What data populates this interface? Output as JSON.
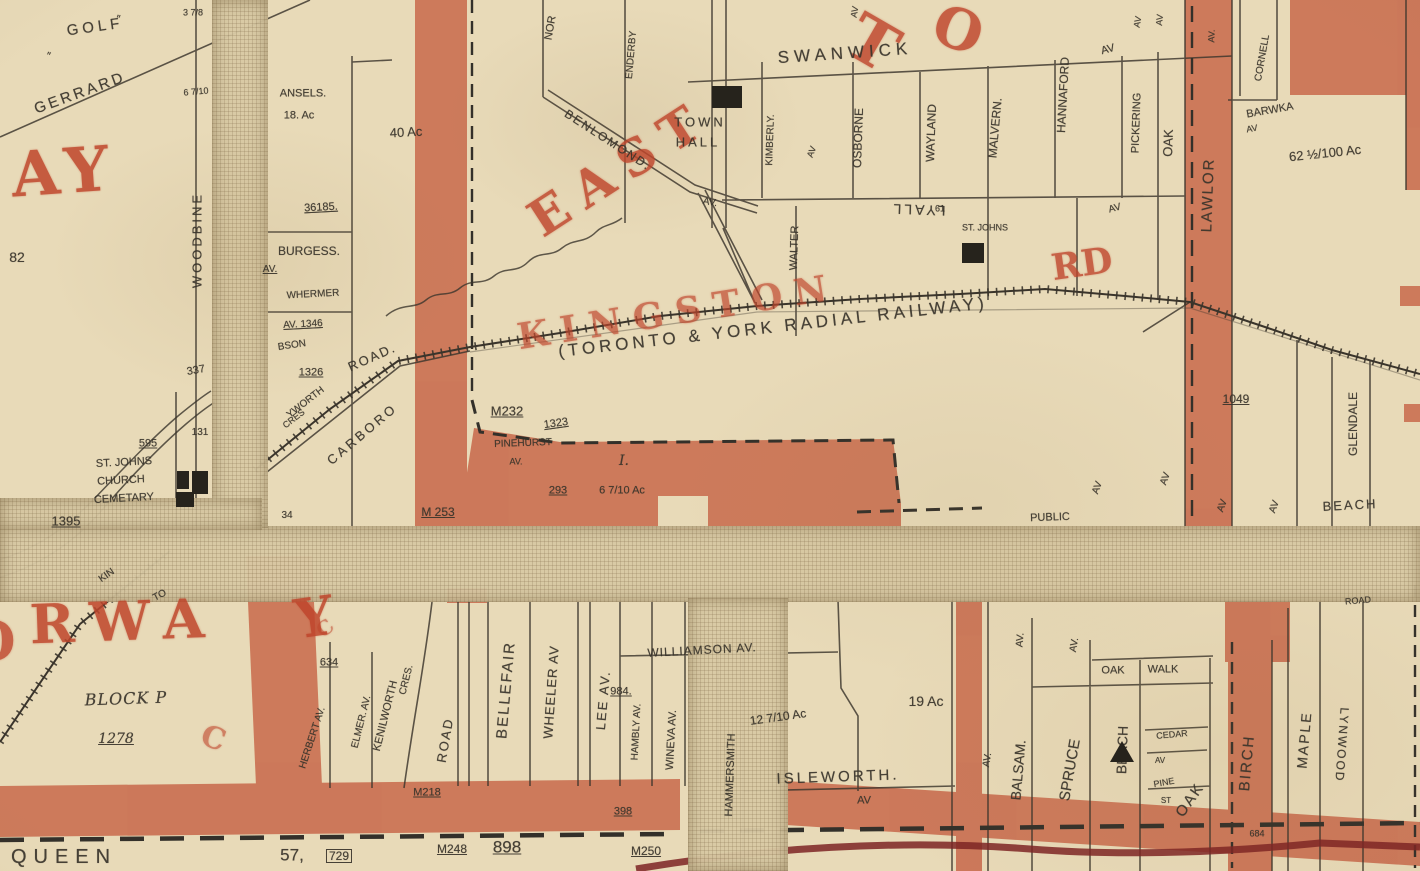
{
  "map": {
    "description": "Scanned historical plan map of East Toronto around Kingston Rd and the Toronto & York Radial Railway",
    "colors": {
      "paper": "#e8dab8",
      "road_fill": "#c8684a",
      "ink": "#39342b",
      "red": "#bf452b",
      "dark_red": "#7c2323"
    },
    "labels": [
      {
        "t": "GOLF",
        "x": 95,
        "y": 27,
        "r": -8,
        "s": 15,
        "ls": 4
      },
      {
        "t": "GERRARD",
        "x": 80,
        "y": 93,
        "r": -20,
        "s": 15,
        "ls": 3
      },
      {
        "t": "″",
        "x": 48,
        "y": 57,
        "r": 15,
        "s": 11
      },
      {
        "t": "″",
        "x": 118,
        "y": 20,
        "r": 10,
        "s": 11
      },
      {
        "t": "3 7/8",
        "x": 193,
        "y": 13,
        "r": 0,
        "s": 9
      },
      {
        "t": "6 7/10",
        "x": 196,
        "y": 92,
        "r": -5,
        "s": 9
      },
      {
        "t": "WOODBINE",
        "x": 197,
        "y": 240,
        "r": -90,
        "s": 13,
        "ls": 3
      },
      {
        "t": "82",
        "x": 17,
        "y": 257,
        "r": 0,
        "s": 14
      },
      {
        "t": "AY",
        "x": 64,
        "y": 172,
        "r": -4,
        "s": 62,
        "ls": 8,
        "cls": "red",
        "c": "red",
        "o": 0.85
      },
      {
        "t": "ANSELS.",
        "x": 303,
        "y": 94,
        "r": 0,
        "s": 11
      },
      {
        "t": "18. Ac",
        "x": 299,
        "y": 116,
        "r": 0,
        "s": 11
      },
      {
        "t": "40 Ac",
        "x": 406,
        "y": 132,
        "r": -3,
        "s": 13
      },
      {
        "t": "36185.",
        "x": 321,
        "y": 208,
        "r": -3,
        "s": 11,
        "cls": "u"
      },
      {
        "t": "BURGESS.",
        "x": 309,
        "y": 251,
        "r": 0,
        "s": 12
      },
      {
        "t": "AV.",
        "x": 270,
        "y": 270,
        "r": 0,
        "s": 10,
        "cls": "u"
      },
      {
        "t": "WHERMER",
        "x": 313,
        "y": 295,
        "r": -3,
        "s": 10
      },
      {
        "t": "AV. 1346",
        "x": 303,
        "y": 325,
        "r": -3,
        "s": 10,
        "cls": "u"
      },
      {
        "t": "BSON",
        "x": 292,
        "y": 346,
        "r": -8,
        "s": 10
      },
      {
        "t": "1326",
        "x": 311,
        "y": 373,
        "r": 0,
        "s": 11,
        "cls": "u"
      },
      {
        "t": "337",
        "x": 196,
        "y": 371,
        "r": -10,
        "s": 11
      },
      {
        "t": "131",
        "x": 200,
        "y": 433,
        "r": 0,
        "s": 10
      },
      {
        "t": "YWORTH",
        "x": 306,
        "y": 403,
        "r": -38,
        "s": 10
      },
      {
        "t": "CRES",
        "x": 294,
        "y": 419,
        "r": -38,
        "s": 9
      },
      {
        "t": "CARBORO",
        "x": 362,
        "y": 434,
        "r": -40,
        "s": 13,
        "ls": 3
      },
      {
        "t": "ROAD.",
        "x": 372,
        "y": 357,
        "r": -24,
        "s": 13,
        "ls": 2
      },
      {
        "t": "EAST",
        "x": 620,
        "y": 168,
        "r": -33,
        "s": 50,
        "ls": 14,
        "cls": "red",
        "c": "red",
        "o": 0.82
      },
      {
        "t": "KINGSTON",
        "x": 678,
        "y": 312,
        "r": -9,
        "s": 36,
        "ls": 12,
        "cls": "red",
        "c": "red",
        "o": 0.68
      },
      {
        "t": "RD",
        "x": 1082,
        "y": 264,
        "r": -8,
        "s": 36,
        "cls": "red",
        "c": "red",
        "o": 0.8
      },
      {
        "t": "T",
        "x": 872,
        "y": 44,
        "r": 30,
        "s": 64,
        "cls": "red",
        "c": "red",
        "o": 0.82
      },
      {
        "t": "O",
        "x": 958,
        "y": 30,
        "r": 20,
        "s": 56,
        "cls": "red",
        "c": "red",
        "o": 0.82
      },
      {
        "t": "NOR",
        "x": 551,
        "y": 28,
        "r": -80,
        "s": 11
      },
      {
        "t": "ENDERBY",
        "x": 632,
        "y": 55,
        "r": -85,
        "s": 10
      },
      {
        "t": "BENLOMOND.",
        "x": 608,
        "y": 140,
        "r": 33,
        "s": 12,
        "ls": 2
      },
      {
        "t": "AV.",
        "x": 710,
        "y": 203,
        "r": 10,
        "s": 10
      },
      {
        "t": "TOWN",
        "x": 700,
        "y": 122,
        "r": 0,
        "s": 13,
        "ls": 3
      },
      {
        "t": "HALL",
        "x": 698,
        "y": 142,
        "r": 0,
        "s": 13,
        "ls": 3
      },
      {
        "t": "SWANWICK",
        "x": 845,
        "y": 53,
        "r": -4,
        "s": 17,
        "ls": 5
      },
      {
        "t": "KIMBERLY.",
        "x": 771,
        "y": 140,
        "r": -88,
        "s": 10
      },
      {
        "t": "AV",
        "x": 812,
        "y": 152,
        "r": -70,
        "s": 9
      },
      {
        "t": "WALTER",
        "x": 795,
        "y": 248,
        "r": -88,
        "s": 11
      },
      {
        "t": "OSBORNE",
        "x": 858,
        "y": 138,
        "r": -88,
        "s": 12
      },
      {
        "t": "AV",
        "x": 855,
        "y": 12,
        "r": -80,
        "s": 9
      },
      {
        "t": "WAYLAND",
        "x": 931,
        "y": 133,
        "r": -88,
        "s": 12
      },
      {
        "t": "MALVERN.",
        "x": 995,
        "y": 128,
        "r": -85,
        "s": 12
      },
      {
        "t": "HANNAFORD",
        "x": 1063,
        "y": 95,
        "r": -87,
        "s": 12
      },
      {
        "t": "PICKERING",
        "x": 1137,
        "y": 123,
        "r": -88,
        "s": 11
      },
      {
        "t": "AV",
        "x": 1138,
        "y": 22,
        "r": -80,
        "s": 9
      },
      {
        "t": "OAK",
        "x": 1168,
        "y": 143,
        "r": -88,
        "s": 13
      },
      {
        "t": "AV",
        "x": 1160,
        "y": 20,
        "r": -85,
        "s": 9
      },
      {
        "t": "AV",
        "x": 1108,
        "y": 50,
        "r": -15,
        "s": 11
      },
      {
        "t": "AV",
        "x": 1115,
        "y": 209,
        "r": -15,
        "s": 10
      },
      {
        "t": "LYALL",
        "x": 918,
        "y": 210,
        "r": 182,
        "s": 14,
        "ls": 3
      },
      {
        "t": "ST. JOHNS",
        "x": 985,
        "y": 228,
        "r": 0,
        "s": 9
      },
      {
        "t": "61",
        "x": 940,
        "y": 209,
        "r": 0,
        "s": 9
      },
      {
        "t": "AV.",
        "x": 1212,
        "y": 36,
        "r": -88,
        "s": 9
      },
      {
        "t": "LAWLOR",
        "x": 1208,
        "y": 195,
        "r": -88,
        "s": 15,
        "ls": 2
      },
      {
        "t": "CORNELL",
        "x": 1263,
        "y": 58,
        "r": -80,
        "s": 10
      },
      {
        "t": "BARWKA",
        "x": 1270,
        "y": 111,
        "r": -10,
        "s": 11
      },
      {
        "t": "AV",
        "x": 1252,
        "y": 129,
        "r": -10,
        "s": 9
      },
      {
        "t": "62 ½/100 Ac",
        "x": 1325,
        "y": 153,
        "r": -6,
        "s": 13
      },
      {
        "t": "(TORONTO & YORK RADIAL RAILWAY)",
        "x": 773,
        "y": 327,
        "r": -6.5,
        "s": 17,
        "ls": 4
      },
      {
        "t": "M232",
        "x": 507,
        "y": 411,
        "r": 0,
        "s": 13,
        "cls": "u"
      },
      {
        "t": "1323",
        "x": 556,
        "y": 424,
        "r": -8,
        "s": 11,
        "cls": "u"
      },
      {
        "t": "PINEHURST",
        "x": 523,
        "y": 444,
        "r": -2,
        "s": 10
      },
      {
        "t": "AV.",
        "x": 516,
        "y": 462,
        "r": 0,
        "s": 9
      },
      {
        "t": "293",
        "x": 558,
        "y": 491,
        "r": 0,
        "s": 11,
        "cls": "u"
      },
      {
        "t": "I.",
        "x": 624,
        "y": 461,
        "r": 0,
        "s": 14,
        "cls": "serif"
      },
      {
        "t": "6 7/10 Ac",
        "x": 622,
        "y": 491,
        "r": 0,
        "s": 11
      },
      {
        "t": "M 253",
        "x": 438,
        "y": 512,
        "r": 0,
        "s": 12,
        "cls": "u"
      },
      {
        "t": "34",
        "x": 287,
        "y": 516,
        "r": 0,
        "s": 10
      },
      {
        "t": "595",
        "x": 148,
        "y": 444,
        "r": 0,
        "s": 11,
        "cls": "u"
      },
      {
        "t": "ST. JOHNS",
        "x": 124,
        "y": 463,
        "r": -3,
        "s": 11
      },
      {
        "t": "CHURCH",
        "x": 121,
        "y": 481,
        "r": -3,
        "s": 11
      },
      {
        "t": "CEMETARY",
        "x": 124,
        "y": 499,
        "r": -3,
        "s": 11
      },
      {
        "t": "1395",
        "x": 66,
        "y": 521,
        "r": 0,
        "s": 13,
        "cls": "u"
      },
      {
        "t": "PUBLIC",
        "x": 1050,
        "y": 518,
        "r": -2,
        "s": 11
      },
      {
        "t": "AV",
        "x": 1098,
        "y": 488,
        "r": -70,
        "s": 10
      },
      {
        "t": "AV",
        "x": 1166,
        "y": 479,
        "r": -70,
        "s": 10
      },
      {
        "t": "AV",
        "x": 1223,
        "y": 506,
        "r": -70,
        "s": 10
      },
      {
        "t": "AV",
        "x": 1275,
        "y": 507,
        "r": -70,
        "s": 10
      },
      {
        "t": "1049",
        "x": 1236,
        "y": 399,
        "r": 0,
        "s": 12,
        "cls": "u"
      },
      {
        "t": "GLENDALE",
        "x": 1353,
        "y": 424,
        "r": -90,
        "s": 12
      },
      {
        "t": "BEACH",
        "x": 1350,
        "y": 505,
        "r": -3,
        "s": 13,
        "ls": 2
      },
      {
        "t": "KIN",
        "x": 107,
        "y": 576,
        "r": -35,
        "s": 10
      },
      {
        "t": "TO",
        "x": 160,
        "y": 596,
        "r": -28,
        "s": 10
      },
      {
        "t": "O",
        "x": -8,
        "y": 641,
        "r": 0,
        "s": 54,
        "cls": "red",
        "c": "red",
        "o": 0.8
      },
      {
        "t": "RWA",
        "x": 125,
        "y": 621,
        "r": -2,
        "s": 54,
        "ls": 16,
        "cls": "red",
        "c": "red",
        "o": 0.85
      },
      {
        "t": "Y",
        "x": 314,
        "y": 617,
        "r": -8,
        "s": 54,
        "cls": "red",
        "c": "red",
        "o": 0.85
      },
      {
        "t": "C",
        "x": 213,
        "y": 739,
        "r": 20,
        "s": 30,
        "cls": "red",
        "c": "red",
        "o": 0.6
      },
      {
        "t": "C",
        "x": 325,
        "y": 628,
        "r": -40,
        "s": 20,
        "cls": "red",
        "c": "red",
        "o": 0.55
      },
      {
        "t": "BLOCK P",
        "x": 126,
        "y": 699,
        "r": -2,
        "s": 16,
        "ls": 1,
        "cls": "serif"
      },
      {
        "t": "1278",
        "x": 116,
        "y": 739,
        "r": 0,
        "s": 14,
        "cls": "serif u"
      },
      {
        "t": "QUEEN",
        "x": 64,
        "y": 857,
        "r": 0,
        "s": 20,
        "ls": 7
      },
      {
        "t": "57,",
        "x": 292,
        "y": 855,
        "r": 0,
        "s": 17
      },
      {
        "t": "729",
        "x": 339,
        "y": 856,
        "r": 0,
        "s": 12,
        "cls": "box"
      },
      {
        "t": "HERBERT AV.",
        "x": 313,
        "y": 738,
        "r": -72,
        "s": 10
      },
      {
        "t": "634",
        "x": 329,
        "y": 663,
        "r": 0,
        "s": 11,
        "cls": "u"
      },
      {
        "t": "ELMER. AV.",
        "x": 362,
        "y": 722,
        "r": -76,
        "s": 10
      },
      {
        "t": "KENILWORTH",
        "x": 386,
        "y": 716,
        "r": -76,
        "s": 11
      },
      {
        "t": "CRES.",
        "x": 407,
        "y": 680,
        "r": -76,
        "s": 10
      },
      {
        "t": "ROAD",
        "x": 445,
        "y": 740,
        "r": -80,
        "s": 13,
        "ls": 2
      },
      {
        "t": "M218",
        "x": 427,
        "y": 793,
        "r": 0,
        "s": 11,
        "cls": "u"
      },
      {
        "t": "BELLEFAIR",
        "x": 506,
        "y": 690,
        "r": -85,
        "s": 15,
        "ls": 2
      },
      {
        "t": "WHEELER AV",
        "x": 551,
        "y": 692,
        "r": -86,
        "s": 13,
        "ls": 1
      },
      {
        "t": "LEE AV.",
        "x": 603,
        "y": 700,
        "r": -85,
        "s": 13,
        "ls": 2
      },
      {
        "t": "984.",
        "x": 621,
        "y": 692,
        "r": 0,
        "s": 11,
        "cls": "u"
      },
      {
        "t": "398",
        "x": 623,
        "y": 812,
        "r": 0,
        "s": 11,
        "cls": "u"
      },
      {
        "t": "M248",
        "x": 452,
        "y": 849,
        "r": 0,
        "s": 12,
        "cls": "u"
      },
      {
        "t": "898",
        "x": 507,
        "y": 847,
        "r": 0,
        "s": 17,
        "cls": "u"
      },
      {
        "t": "M250",
        "x": 646,
        "y": 851,
        "r": 0,
        "s": 12,
        "cls": "u"
      },
      {
        "t": "WILLIAMSON AV.",
        "x": 702,
        "y": 650,
        "r": -3,
        "s": 12,
        "ls": 1
      },
      {
        "t": "HAMBLY AV.",
        "x": 637,
        "y": 732,
        "r": -87,
        "s": 10
      },
      {
        "t": "WINEVA AV.",
        "x": 672,
        "y": 740,
        "r": -87,
        "s": 11
      },
      {
        "t": "HAMMERSMITH",
        "x": 731,
        "y": 775,
        "r": -88,
        "s": 11
      },
      {
        "t": "12 7/10 Ac",
        "x": 778,
        "y": 717,
        "r": -8,
        "s": 12
      },
      {
        "t": "ISLEWORTH.",
        "x": 838,
        "y": 777,
        "r": -2,
        "s": 15,
        "ls": 3
      },
      {
        "t": "AV",
        "x": 864,
        "y": 801,
        "r": 0,
        "s": 11
      },
      {
        "t": "19 Ac",
        "x": 926,
        "y": 701,
        "r": 0,
        "s": 14
      },
      {
        "t": "BALSAM.",
        "x": 1018,
        "y": 770,
        "r": -85,
        "s": 14
      },
      {
        "t": "AV.",
        "x": 1021,
        "y": 640,
        "r": -85,
        "s": 10
      },
      {
        "t": "SPRUCE",
        "x": 1070,
        "y": 770,
        "r": -80,
        "s": 15
      },
      {
        "t": "AV.",
        "x": 1075,
        "y": 645,
        "r": -80,
        "s": 10
      },
      {
        "t": "BEACH",
        "x": 1122,
        "y": 750,
        "r": -88,
        "s": 14
      },
      {
        "t": "OAK",
        "x": 1113,
        "y": 671,
        "r": 0,
        "s": 11
      },
      {
        "t": "WALK",
        "x": 1163,
        "y": 670,
        "r": 0,
        "s": 11
      },
      {
        "t": "CEDAR",
        "x": 1172,
        "y": 735,
        "r": -5,
        "s": 9
      },
      {
        "t": "AV",
        "x": 1160,
        "y": 761,
        "r": 0,
        "s": 8
      },
      {
        "t": "PINE",
        "x": 1164,
        "y": 783,
        "r": -10,
        "s": 9
      },
      {
        "t": "ST",
        "x": 1166,
        "y": 801,
        "r": 0,
        "s": 8
      },
      {
        "t": "OAK",
        "x": 1190,
        "y": 800,
        "r": -55,
        "s": 15,
        "ls": 2
      },
      {
        "t": "BIRCH",
        "x": 1247,
        "y": 763,
        "r": -85,
        "s": 15,
        "ls": 2
      },
      {
        "t": "684",
        "x": 1257,
        "y": 834,
        "r": 0,
        "s": 9
      },
      {
        "t": "AV.",
        "x": 988,
        "y": 760,
        "r": -80,
        "s": 10
      },
      {
        "t": "MAPLE",
        "x": 1304,
        "y": 740,
        "r": -85,
        "s": 14,
        "ls": 2
      },
      {
        "t": "LYNWOOD",
        "x": 1342,
        "y": 745,
        "r": 94,
        "s": 12,
        "ls": 2
      },
      {
        "t": "ROAD",
        "x": 1358,
        "y": 601,
        "r": -5,
        "s": 9
      }
    ],
    "buildings": [
      {
        "x": 712,
        "y": 86,
        "w": 30,
        "h": 22,
        "shape": "rect",
        "name": "town-hall-building"
      },
      {
        "x": 962,
        "y": 243,
        "w": 22,
        "h": 20,
        "shape": "rect",
        "name": "st-johns-building"
      },
      {
        "x": 177,
        "y": 471,
        "w": 12,
        "h": 18,
        "shape": "rect",
        "name": "cemetery-building"
      },
      {
        "x": 192,
        "y": 471,
        "w": 16,
        "h": 23,
        "shape": "rect",
        "name": "cemetery-building"
      },
      {
        "x": 176,
        "y": 492,
        "w": 18,
        "h": 15,
        "shape": "rect",
        "name": "cemetery-building"
      },
      {
        "x": 1110,
        "y": 741,
        "w": 24,
        "h": 21,
        "shape": "tri",
        "name": "beach-av-building"
      }
    ]
  }
}
